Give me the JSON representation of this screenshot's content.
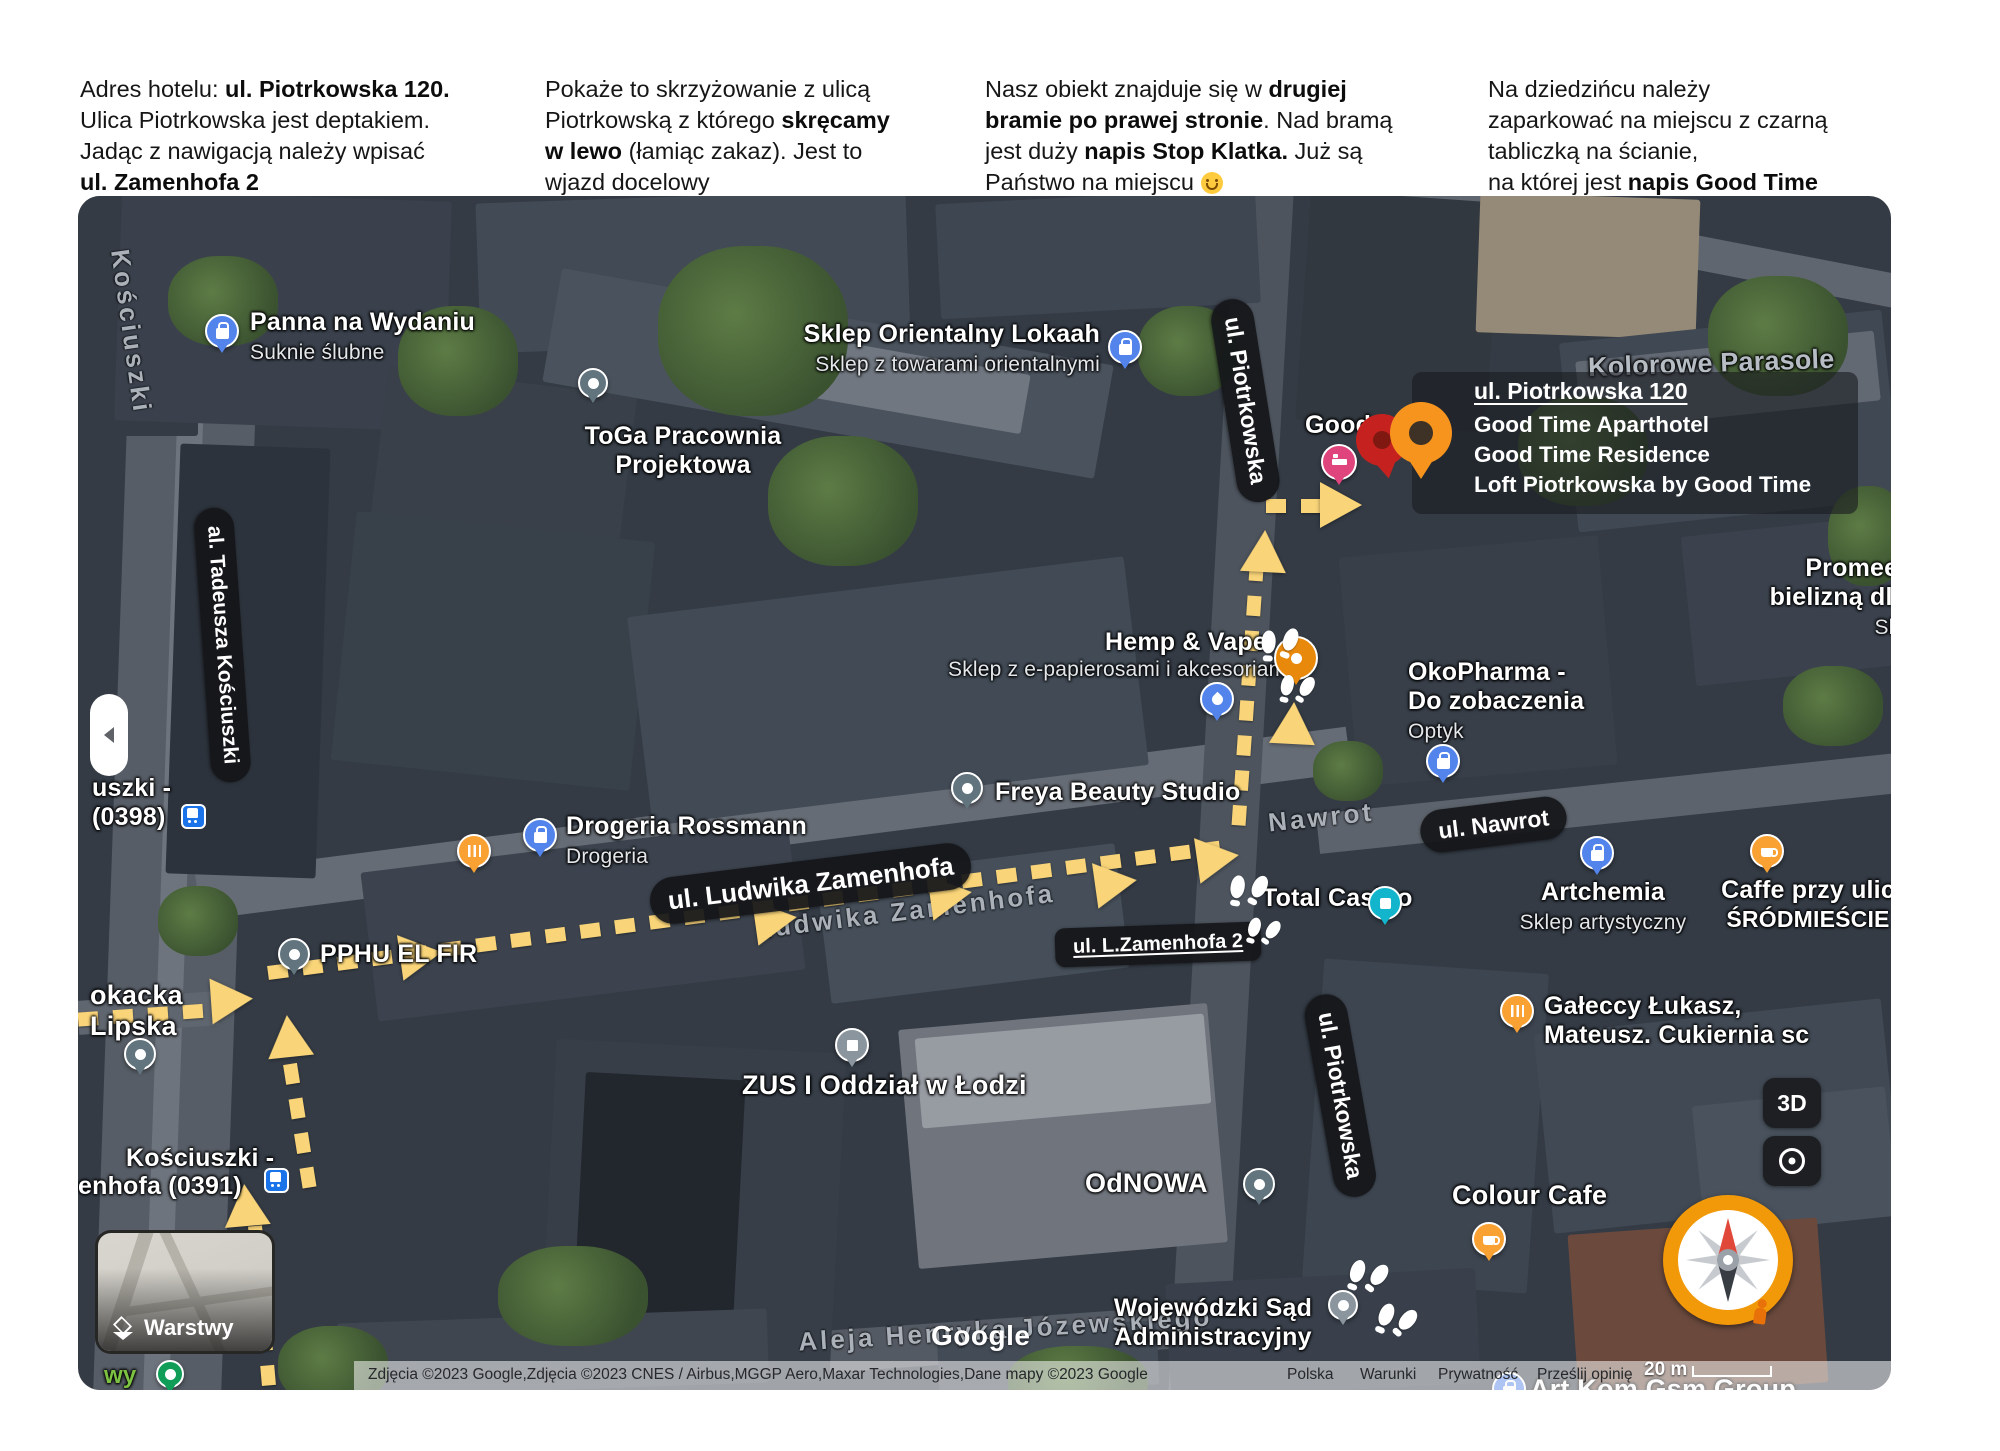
{
  "instructions": [
    {
      "segments": [
        {
          "t": "Adres hotelu: "
        },
        {
          "t": "ul. Piotrkowska 120.",
          "b": true
        },
        {
          "br": true
        },
        {
          "t": "Ulica Piotrkowska jest deptakiem."
        },
        {
          "br": true
        },
        {
          "t": "Jadąc z nawigacją należy wpisać"
        },
        {
          "br": true
        },
        {
          "t": "ul. Zamenhofa 2",
          "b": true
        }
      ]
    },
    {
      "segments": [
        {
          "t": "Pokaże to skrzyżowanie z ulicą"
        },
        {
          "br": true
        },
        {
          "t": "Piotrkowską z którego "
        },
        {
          "t": "skręcamy",
          "b": true
        },
        {
          "br": true
        },
        {
          "t": "w lewo",
          "b": true
        },
        {
          "t": " (łamiąc zakaz). Jest to"
        },
        {
          "br": true
        },
        {
          "t": "wjazd docelowy"
        }
      ]
    },
    {
      "segments": [
        {
          "t": "Nasz obiekt znajduje się w "
        },
        {
          "t": "drugiej",
          "b": true
        },
        {
          "br": true
        },
        {
          "t": "bramie po prawej stronie",
          "b": true
        },
        {
          "t": ". Nad bramą"
        },
        {
          "br": true
        },
        {
          "t": "jest duży "
        },
        {
          "t": "napis Stop Klatka.",
          "b": true
        },
        {
          "t": " Już są"
        },
        {
          "br": true
        },
        {
          "t": "Państwo na miejscu "
        },
        {
          "emoji": true
        }
      ]
    },
    {
      "segments": [
        {
          "t": "Na dziedzińcu należy"
        },
        {
          "br": true
        },
        {
          "t": "zaparkować na miejscu z czarną"
        },
        {
          "br": true
        },
        {
          "t": "tabliczką na ścianie,"
        },
        {
          "br": true
        },
        {
          "t": "na której jest "
        },
        {
          "t": "napis Good Time",
          "b": true
        }
      ]
    }
  ],
  "map": {
    "popup": {
      "title": "ul. Piotrkowska 120",
      "lines": [
        "Good Time Aparthotel",
        "Good Time Residence",
        "Loft Piotrkowska by Good Time"
      ]
    },
    "streets": {
      "piotrkowska_top": "ul. Piotrkowska",
      "piotrkowska_bottom": "ul. Piotrkowska",
      "nawrot": "ul. Nawrot",
      "zamenhofa": "ul. Ludwika Zamenhofa",
      "zamenhofa2": "ul. L.Zamenhofa 2",
      "kosciuszki": "al. Tadeusza Kościuszki",
      "gray_nawrot": "Nawrot",
      "gray_zamenhofa": "Ludwika Zamenhofa",
      "gray_kosciuszki": "Kościuszki",
      "gray_aleja": "Aleja Henryka Józewskiego"
    },
    "pois": {
      "panna": [
        "Panna na Wydaniu",
        "Suknie ślubne"
      ],
      "orientalny": [
        "Sklep Orientalny Lokaah",
        "Sklep z towarami orientalnymi"
      ],
      "toga": [
        "ToGa Pracownia",
        "Projektowa"
      ],
      "kolorowe": "Kolorowe Parasole",
      "promees": [
        "Promees -",
        "bielizną dla k",
        "Sklep"
      ],
      "hemp": [
        "Hemp & Vape",
        "Sklep z e-papierosami i akcesoriami"
      ],
      "okopharma": [
        "OkoPharma -",
        "Do zobaczenia",
        "Optyk"
      ],
      "freya": "Freya Beauty Studio",
      "drogeria": [
        "Drogeria Rossmann",
        "Drogeria"
      ],
      "pphu": "PPHU EL FIR",
      "casino": "Total Casino",
      "artchemia": [
        "Artchemia",
        "Sklep artystyczny"
      ],
      "caffe": [
        "Caffe przy ulic",
        "ŚRÓDMIEŚCIE"
      ],
      "galeccy": [
        "Gałeccy Łukasz,",
        "Mateusz. Cukiernia sc"
      ],
      "zus": "ZUS I Oddział w Łodzi",
      "odnowa": "OdNOWA",
      "sad": [
        "Wojewódzki Sąd",
        "Administracyjny"
      ],
      "colour": "Colour Cafe",
      "artkom": "Art Kom Gsm Group",
      "good": "Good",
      "okacka": [
        "okacka",
        "Lipska"
      ],
      "green_frag": "wy"
    },
    "transit": {
      "stop398": [
        "uszki -",
        "(0398)"
      ],
      "stop391": [
        "Kościuszki -",
        "enhofa (0391)"
      ]
    },
    "controls": {
      "layers": "Warstwy",
      "three_d": "3D",
      "scale": "20 m"
    },
    "attribution": {
      "credits": "Zdjęcia ©2023 Google,Zdjęcia ©2023 CNES / Airbus,MGGP Aero,Maxar Technologies,Dane mapy ©2023 Google",
      "links": [
        "Polska",
        "Warunki",
        "Prywatność",
        "Prześlij opinię"
      ],
      "logo": "Google"
    },
    "colors": {
      "route_yellow": "#F9D478",
      "pin_blue": "#5384EC",
      "pin_teal": "#12B5CB",
      "pin_slate": "#62757f",
      "pin_orange": "#F9A133",
      "pin_pink": "#E0447C",
      "hotel_pin_orange": "#F7941E",
      "hotel_pin_red": "#C5221F",
      "pill_background": "#202124"
    }
  }
}
